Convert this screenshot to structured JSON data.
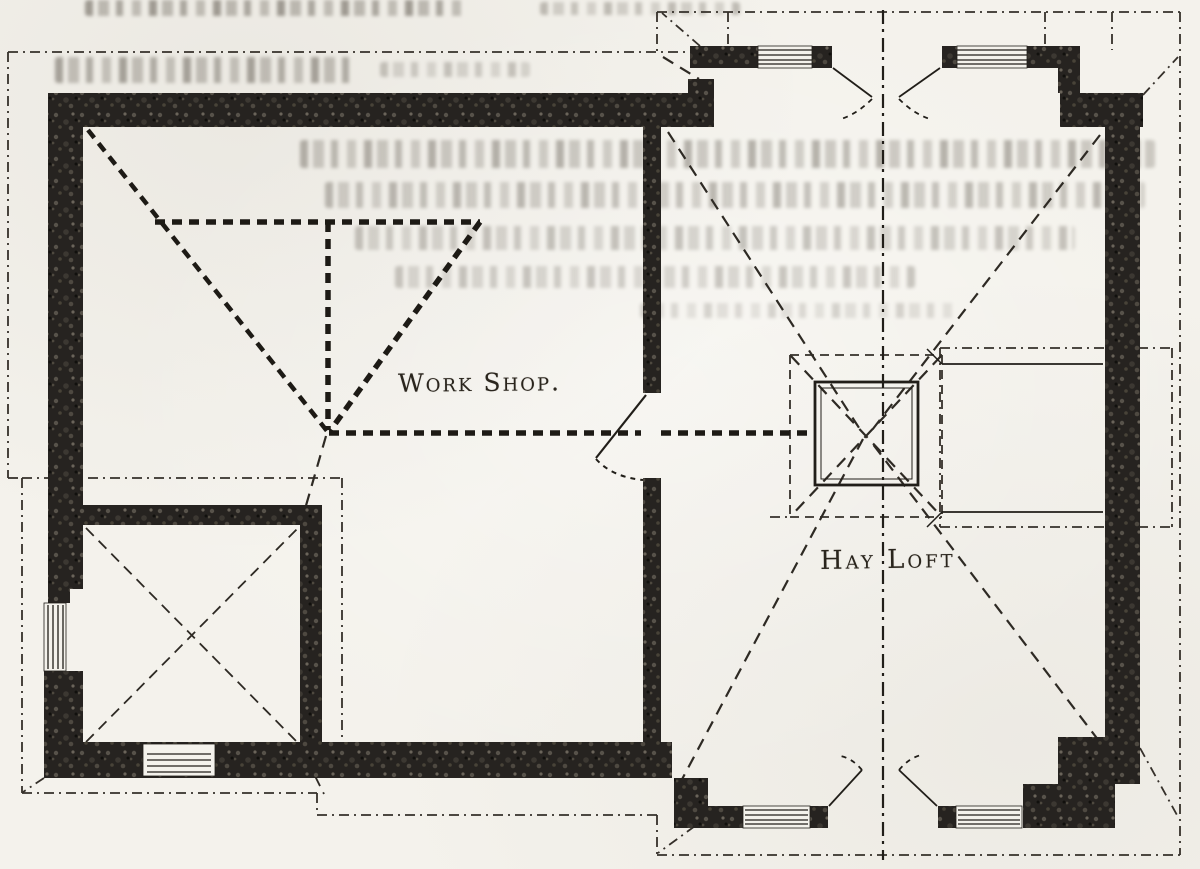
{
  "labels": {
    "workshop": "Work Shop.",
    "hay_loft": "Hay Loft"
  },
  "colors": {
    "ink": "#211e19",
    "wall_fill": "#262320",
    "paper": "#f4f2ec",
    "eave_line": "#35302a"
  }
}
